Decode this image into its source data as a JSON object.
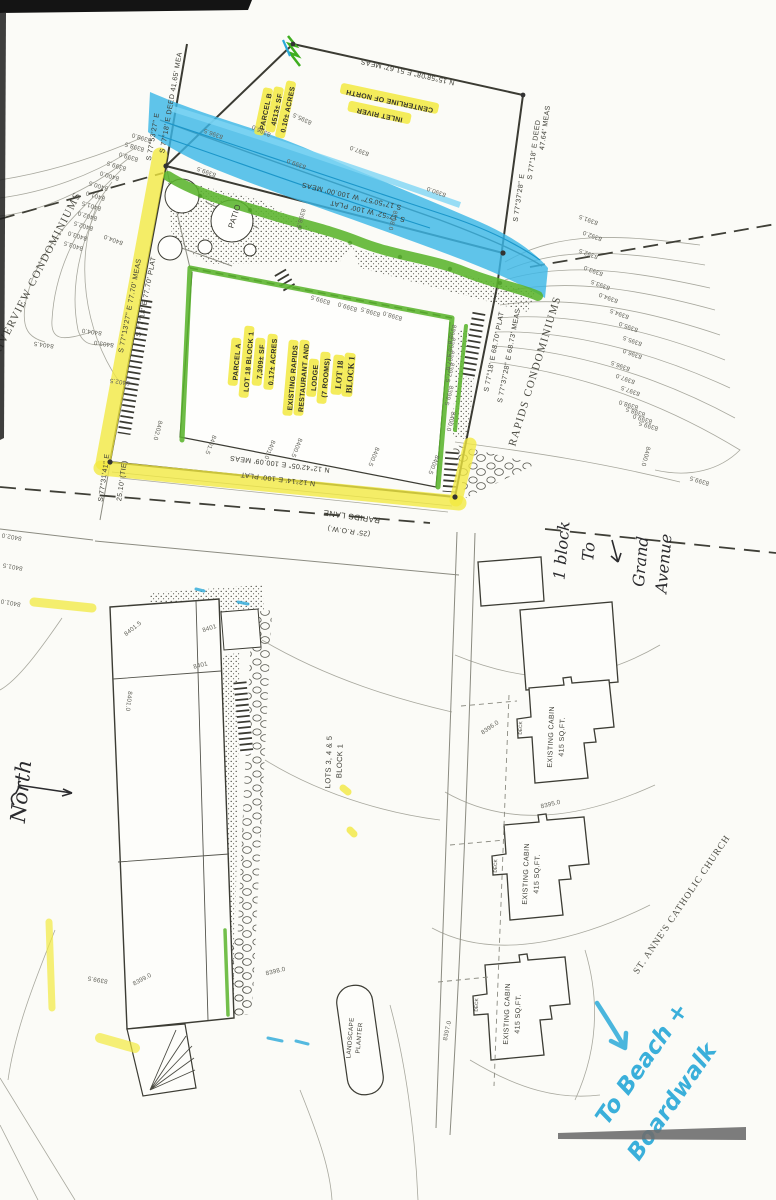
{
  "colors": {
    "highlighter_yellow": "#f2e93f",
    "highlighter_green": "#5ab42c",
    "river_blue": "#3cb7e6",
    "marker_blue": "#2aa9d8",
    "ink": "#3b3b33"
  },
  "upper": {
    "bearings": {
      "top_edge": "N 15°58'08\" E   51.67' MEAS",
      "nw_deed": "S 77°18' E  DEED  41.65' MEA",
      "nw_meas": "S 77°53'27\" E",
      "e_deed": "S 77°18' E  DEED",
      "e_deed_dist": "47.64' MEAS",
      "e_meas": "S 77°37'28\" E",
      "river_meas": "S 17°50'57\" W  100.00' MEAS",
      "river_plat": "S 17°52' W  100'  PLAT",
      "w_plat": "S 77°18' E  77.70'  PLAT",
      "w_meas": "S 77°13'27\" E  77.70' MEAS",
      "tie_bearing": "S 77°31'41\" E",
      "tie_dist": "25.10' (TIE)",
      "s_meas": "N 12°42'05\" E  100.09' MEAS",
      "s_plat": "N 12°14' E  100'  PLAT",
      "se_plat": "S 77°18' E  68.70'  PLAT",
      "se_meas": "S 77°37'28\" E  68.73' MEAS"
    },
    "centerline": [
      "CENTERLINE OF NORTH",
      "INLET RIVER"
    ],
    "parcel_b": [
      "PARCEL B",
      "4513± SF",
      "0.10± ACRES"
    ],
    "parcel_a": [
      "PARCEL A",
      "LOT 18 BLOCK 1",
      "7,309± SF",
      "0.17± ACRES"
    ],
    "lodge": [
      "EXISTING RAPIDS",
      "RESTAURANT AND",
      "LODGE",
      "(7 ROOMS)"
    ],
    "lot18": [
      "LOT 18",
      "BLOCK 1"
    ],
    "patio": "PATIO",
    "riverview": "RIVERVIEW CONDOMINIUMS",
    "rapids_condos": "RAPIDS CONDOMINIUMS"
  },
  "road": {
    "name": "RAPIDS LANE",
    "row": "(25' R.O.W.)"
  },
  "lower": {
    "lots_label": [
      "LOTS 3, 4 & 5",
      "BLOCK 1"
    ],
    "cabin": [
      "EXISTING CABIN",
      "415 SQ.FT."
    ],
    "deck": "DECK",
    "planter": [
      "LANDSCAPE",
      "PLANTER"
    ],
    "church": "ST. ANNE'S CATHOLIC CHURCH"
  },
  "handwriting": {
    "north": "North",
    "block1": "1 block",
    "to": "To",
    "grand": "Grand",
    "avenue": "Avenue",
    "beach1": "To Beach +",
    "beach2": "Boardwalk"
  },
  "contour_labels": [
    {
      "t": "8398.0",
      "x": 142,
      "y": 136,
      "r": 197
    },
    {
      "t": "8398.5",
      "x": 135,
      "y": 145,
      "r": 197
    },
    {
      "t": "8399.0",
      "x": 129,
      "y": 155,
      "r": 197
    },
    {
      "t": "8399.5",
      "x": 117,
      "y": 164,
      "r": 197
    },
    {
      "t": "8400.0",
      "x": 110,
      "y": 174,
      "r": 197
    },
    {
      "t": "8400.5",
      "x": 99,
      "y": 184,
      "r": 197
    },
    {
      "t": "8401.0",
      "x": 96,
      "y": 194,
      "r": 197
    },
    {
      "t": "8401.5",
      "x": 92,
      "y": 204,
      "r": 197
    },
    {
      "t": "8402.0",
      "x": 88,
      "y": 214,
      "r": 197
    },
    {
      "t": "8402.5",
      "x": 84,
      "y": 224,
      "r": 197
    },
    {
      "t": "8403.0",
      "x": 78,
      "y": 234,
      "r": 197
    },
    {
      "t": "8403.5",
      "x": 74,
      "y": 244,
      "r": 197
    },
    {
      "t": "8404.0",
      "x": 114,
      "y": 238,
      "r": 200
    },
    {
      "t": "8404.0",
      "x": 92,
      "y": 330,
      "r": 188
    },
    {
      "t": "8404.5",
      "x": 44,
      "y": 343,
      "r": 188
    },
    {
      "t": "8403.0",
      "x": 104,
      "y": 342,
      "r": 188
    },
    {
      "t": "8402.5",
      "x": 120,
      "y": 380,
      "r": 188
    },
    {
      "t": "8390.0",
      "x": 437,
      "y": 190,
      "r": 200
    },
    {
      "t": "8391.5",
      "x": 589,
      "y": 218,
      "r": 200
    },
    {
      "t": "8392.0",
      "x": 593,
      "y": 234,
      "r": 200
    },
    {
      "t": "8392.5",
      "x": 589,
      "y": 252,
      "r": 200
    },
    {
      "t": "8393.0",
      "x": 594,
      "y": 269,
      "r": 200
    },
    {
      "t": "8393.5",
      "x": 601,
      "y": 283,
      "r": 200
    },
    {
      "t": "8394.0",
      "x": 609,
      "y": 296,
      "r": 200
    },
    {
      "t": "8394.5",
      "x": 620,
      "y": 312,
      "r": 200
    },
    {
      "t": "8395.0",
      "x": 629,
      "y": 325,
      "r": 200
    },
    {
      "t": "8395.5",
      "x": 633,
      "y": 339,
      "r": 200
    },
    {
      "t": "8396.0",
      "x": 633,
      "y": 352,
      "r": 200
    },
    {
      "t": "8396.5",
      "x": 621,
      "y": 364,
      "r": 200
    },
    {
      "t": "8397.0",
      "x": 626,
      "y": 377,
      "r": 200
    },
    {
      "t": "8397.5",
      "x": 631,
      "y": 389,
      "r": 200
    },
    {
      "t": "8398.0",
      "x": 629,
      "y": 403,
      "r": 197
    },
    {
      "t": "8398.5",
      "x": 636,
      "y": 410,
      "r": 197
    },
    {
      "t": "8399.0",
      "x": 643,
      "y": 417,
      "r": 197
    },
    {
      "t": "8399.5",
      "x": 649,
      "y": 424,
      "r": 197
    },
    {
      "t": "8400.0",
      "x": 644,
      "y": 456,
      "r": 105
    },
    {
      "t": "8399.5",
      "x": 700,
      "y": 479,
      "r": 197
    },
    {
      "t": "8395.5",
      "x": 303,
      "y": 117,
      "r": 205,
      "s": 5.6
    },
    {
      "t": "8396.0",
      "x": 262,
      "y": 129,
      "r": 205,
      "s": 5.6
    },
    {
      "t": "8396.5",
      "x": 214,
      "y": 132,
      "r": 200,
      "s": 5.6
    },
    {
      "t": "8397.0",
      "x": 360,
      "y": 149,
      "r": 200,
      "s": 5.6
    },
    {
      "t": "8399.0",
      "x": 297,
      "y": 162,
      "r": 200,
      "s": 5.6
    },
    {
      "t": "8399.5",
      "x": 207,
      "y": 170,
      "r": 200,
      "s": 5.6
    },
    {
      "t": "8398.0",
      "x": 391,
      "y": 220,
      "r": 105,
      "s": 5.6
    },
    {
      "t": "8398.5",
      "x": 299,
      "y": 218,
      "r": 105,
      "s": 5.6
    },
    {
      "t": "8399.5",
      "x": 321,
      "y": 298,
      "r": 197
    },
    {
      "t": "8399.0",
      "x": 348,
      "y": 305,
      "r": 197
    },
    {
      "t": "8398.5",
      "x": 371,
      "y": 310,
      "r": 197
    },
    {
      "t": "8398.0",
      "x": 393,
      "y": 314,
      "r": 197
    },
    {
      "t": "8396.0",
      "x": 450,
      "y": 334,
      "r": 105
    },
    {
      "t": "8396.5",
      "x": 449,
      "y": 347,
      "r": 105
    },
    {
      "t": "8397.0",
      "x": 448,
      "y": 360,
      "r": 105
    },
    {
      "t": "8397.5",
      "x": 448,
      "y": 372,
      "r": 105
    },
    {
      "t": "8399.5",
      "x": 447,
      "y": 395,
      "r": 105
    },
    {
      "t": "8400.0",
      "x": 449,
      "y": 421,
      "r": 105
    },
    {
      "t": "8402.0",
      "x": 156,
      "y": 430,
      "r": 105
    },
    {
      "t": "8401.5",
      "x": 209,
      "y": 444,
      "r": 112
    },
    {
      "t": "8401.0",
      "x": 268,
      "y": 449,
      "r": 112
    },
    {
      "t": "8400.5",
      "x": 295,
      "y": 447,
      "r": 112
    },
    {
      "t": "8400.5",
      "x": 372,
      "y": 456,
      "r": 112
    },
    {
      "t": "8400.5",
      "x": 432,
      "y": 464,
      "r": 112
    },
    {
      "t": "8402.0",
      "x": 12,
      "y": 535,
      "r": 190
    },
    {
      "t": "8401.5",
      "x": 13,
      "y": 565,
      "r": 190
    },
    {
      "t": "8401.0",
      "x": 11,
      "y": 601,
      "r": 190
    },
    {
      "t": "8401.5",
      "x": 134,
      "y": 630,
      "r": -38
    },
    {
      "t": "8401",
      "x": 210,
      "y": 630,
      "r": -18
    },
    {
      "t": "8401",
      "x": 201,
      "y": 667,
      "r": -14
    },
    {
      "t": "8401.0",
      "x": 127,
      "y": 701,
      "r": 97
    },
    {
      "t": "8399.0",
      "x": 143,
      "y": 981,
      "r": -28
    },
    {
      "t": "8399.5",
      "x": 98,
      "y": 978,
      "r": 190
    },
    {
      "t": "8398.0",
      "x": 276,
      "y": 973,
      "r": -14
    },
    {
      "t": "8397.0",
      "x": 449,
      "y": 1031,
      "r": -78
    },
    {
      "t": "8396.0",
      "x": 491,
      "y": 729,
      "r": -35
    },
    {
      "t": "8395.0",
      "x": 551,
      "y": 806,
      "r": -14
    }
  ]
}
